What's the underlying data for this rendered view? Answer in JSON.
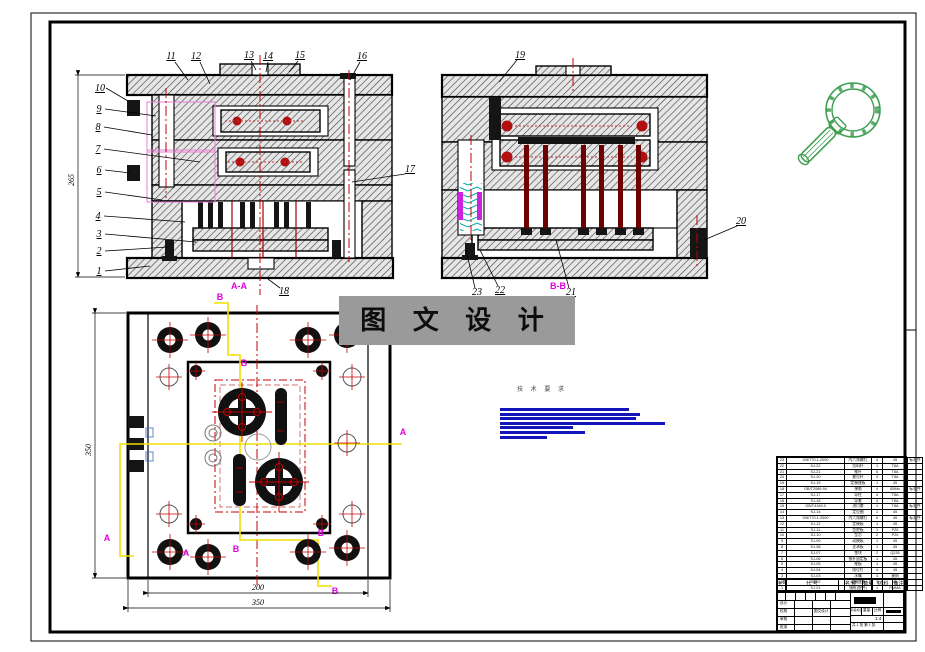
{
  "colors": {
    "centerline_red": "#cc0000",
    "section_yellow": "#f0e000",
    "section_magenta": "#e000e0",
    "redacted_blue": "#1414bb",
    "part_green": "#3f9e52",
    "watermark_bg": "#9a9a9a"
  },
  "watermark": {
    "text": "图 文 设 计"
  },
  "notes": {
    "tech": "技 术 要 求"
  },
  "sections": {
    "aa": "A-A",
    "bb": "B-B",
    "a": "A",
    "b": "B"
  },
  "dims": {
    "plan_inner_width": "200",
    "plan_outer_width": "350",
    "plan_height": "350",
    "front_height": "265"
  },
  "callouts": {
    "numbers": [
      "1",
      "2",
      "3",
      "4",
      "5",
      "6",
      "7",
      "8",
      "9",
      "10",
      "11",
      "12",
      "13",
      "14",
      "15",
      "16",
      "17",
      "18",
      "19",
      "20",
      "21",
      "22",
      "23"
    ]
  },
  "bom": {
    "headers": [
      "序号",
      "代  号",
      "名  称",
      "数量",
      "材  料",
      "备注"
    ],
    "rows": [
      {
        "no": "23",
        "code": "GB/T70.1-2000",
        "name": "内六角螺钉",
        "qty": "4",
        "mat": "45",
        "rem": "标准件"
      },
      {
        "no": "22",
        "code": "SJ-22",
        "name": "拉料杆",
        "qty": "1",
        "mat": "T8A",
        "rem": ""
      },
      {
        "no": "21",
        "code": "SJ-21",
        "name": "推杆",
        "qty": "6",
        "mat": "T8A",
        "rem": ""
      },
      {
        "no": "20",
        "code": "SJ-20",
        "name": "复位杆",
        "qty": "4",
        "mat": "T8A",
        "rem": ""
      },
      {
        "no": "19",
        "code": "SJ-19",
        "name": "定模座板",
        "qty": "1",
        "mat": "45",
        "rem": ""
      },
      {
        "no": "18",
        "code": "GB/T2089-94",
        "name": "弹簧",
        "qty": "4",
        "mat": "65Mn",
        "rem": "标准件"
      },
      {
        "no": "17",
        "code": "SJ-17",
        "name": "导柱",
        "qty": "4",
        "mat": "T8A",
        "rem": ""
      },
      {
        "no": "16",
        "code": "SJ-16",
        "name": "导套",
        "qty": "4",
        "mat": "T8A",
        "rem": ""
      },
      {
        "no": "15",
        "code": "GB/T4169.3",
        "name": "浇口套",
        "qty": "1",
        "mat": "T8A",
        "rem": "标准件"
      },
      {
        "no": "14",
        "code": "SJ-14",
        "name": "定位圈",
        "qty": "1",
        "mat": "45",
        "rem": ""
      },
      {
        "no": "13",
        "code": "GB/T70.1-2000",
        "name": "内六角螺钉",
        "qty": "6",
        "mat": "45",
        "rem": "标准件"
      },
      {
        "no": "12",
        "code": "SJ-12",
        "name": "定模板",
        "qty": "1",
        "mat": "45",
        "rem": ""
      },
      {
        "no": "11",
        "code": "SJ-11",
        "name": "型腔板",
        "qty": "1",
        "mat": "P20",
        "rem": ""
      },
      {
        "no": "10",
        "code": "SJ-10",
        "name": "型芯",
        "qty": "2",
        "mat": "P20",
        "rem": ""
      },
      {
        "no": "9",
        "code": "SJ-09",
        "name": "动模板",
        "qty": "1",
        "mat": "45",
        "rem": ""
      },
      {
        "no": "8",
        "code": "SJ-08",
        "name": "支承板",
        "qty": "1",
        "mat": "45",
        "rem": ""
      },
      {
        "no": "7",
        "code": "SJ-07",
        "name": "垫块",
        "qty": "2",
        "mat": "Q235",
        "rem": ""
      },
      {
        "no": "6",
        "code": "SJ-06",
        "name": "推杆固定板",
        "qty": "1",
        "mat": "45",
        "rem": ""
      },
      {
        "no": "5",
        "code": "SJ-05",
        "name": "推板",
        "qty": "1",
        "mat": "45",
        "rem": ""
      },
      {
        "no": "4",
        "code": "SJ-04",
        "name": "限位钉",
        "qty": "4",
        "mat": "45",
        "rem": ""
      },
      {
        "no": "3",
        "code": "SJ-03",
        "name": "水嘴",
        "qty": "4",
        "mat": "黄铜",
        "rem": ""
      },
      {
        "no": "2",
        "code": "SJ-02",
        "name": "动模座板",
        "qty": "1",
        "mat": "45",
        "rem": ""
      },
      {
        "no": "1",
        "code": "SJ-01",
        "name": "镜框(塑件)",
        "qty": "1",
        "mat": "PMMA",
        "rem": ""
      }
    ]
  },
  "title_block": {
    "design": "设计",
    "check": "校核",
    "audit": "审核",
    "approve": "批准",
    "stage": "阶段标记",
    "weight": "重量",
    "scale_label": "比例",
    "scale": "1:4",
    "sheet": "共 1 张  第 1 张",
    "org": "图文设计"
  }
}
